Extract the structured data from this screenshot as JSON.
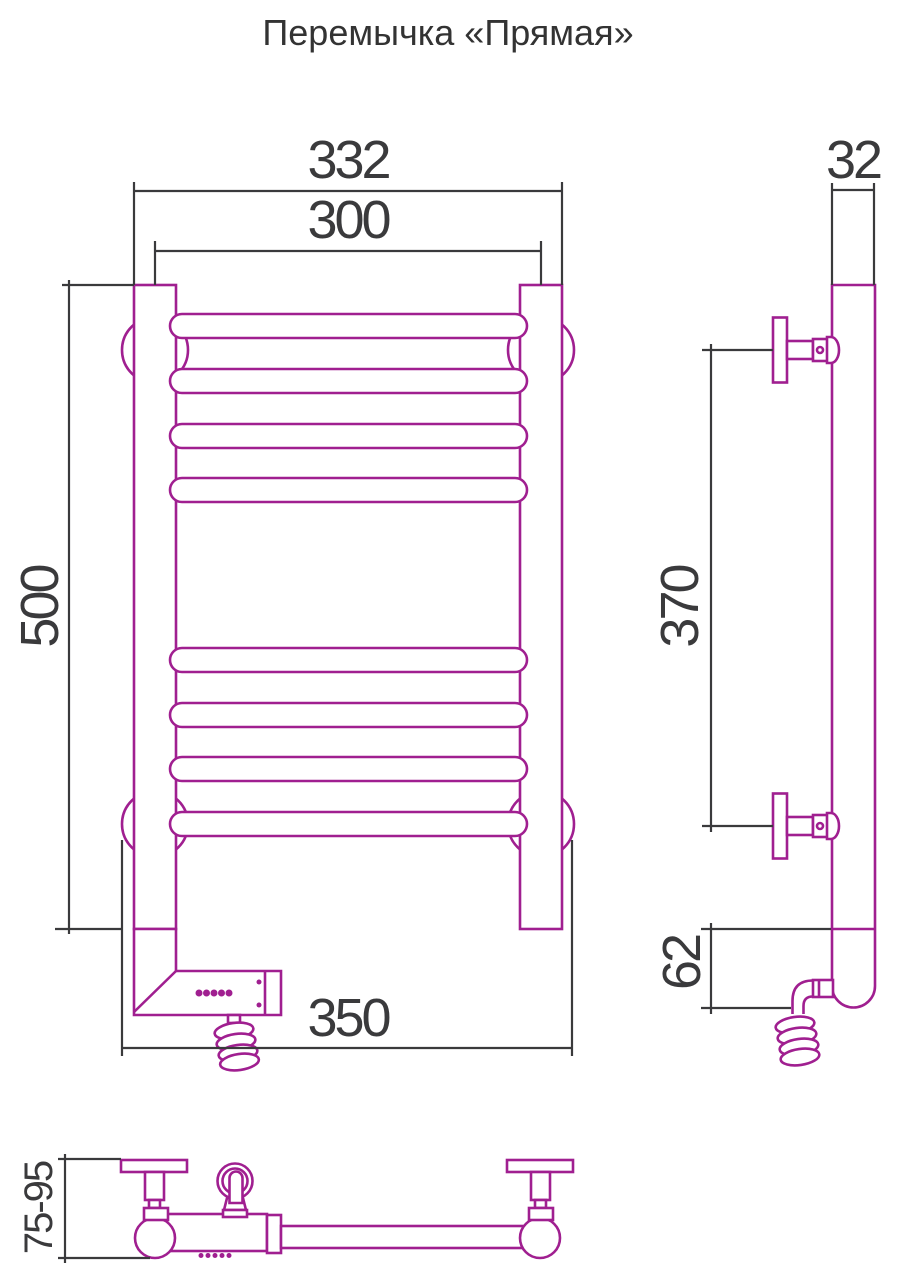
{
  "title": "Перемычка «Прямая»",
  "colors": {
    "product_outline": "#A01F90",
    "dimension_ink": "#3A3A3C",
    "background": "#FFFFFF"
  },
  "front_view": {
    "dim_overall_width": "332",
    "dim_center_distance": "300",
    "dim_height": "500",
    "dim_bottom_width": "350"
  },
  "side_view": {
    "dim_tube_width": "32",
    "dim_bracket_spacing": "370",
    "dim_bottom_offset": "62"
  },
  "plan_view": {
    "dim_wall_distance": "75-95"
  }
}
